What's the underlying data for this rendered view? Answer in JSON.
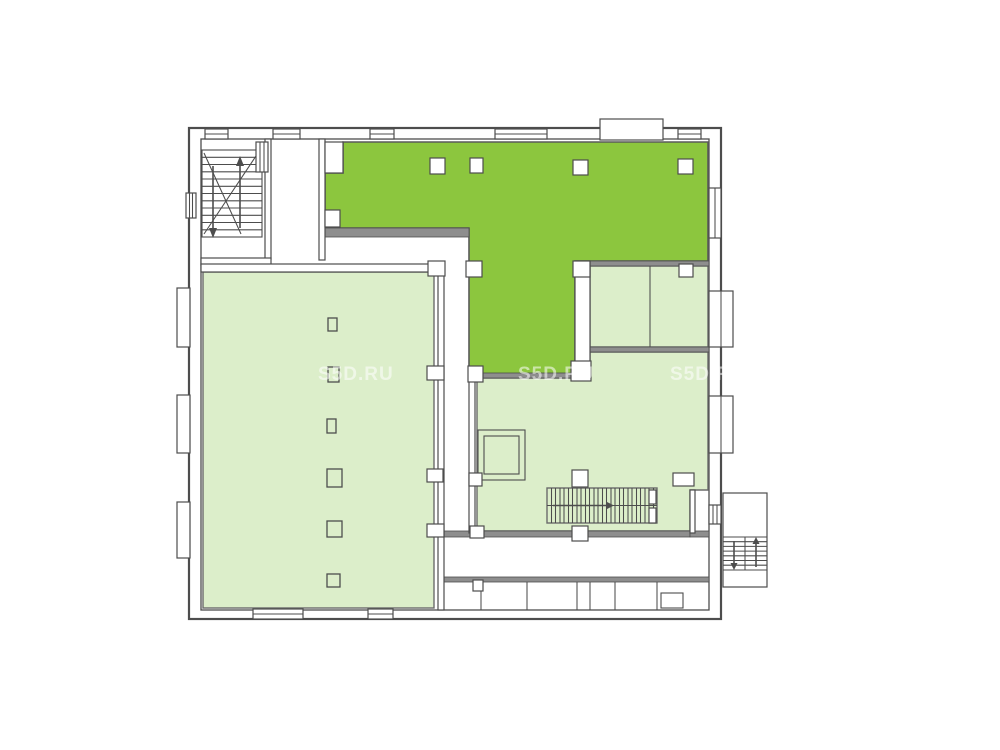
{
  "watermark": {
    "text": "S5D.RU",
    "opacity": 0.55,
    "instances": [
      {
        "x": 318,
        "y": 380
      },
      {
        "x": 518,
        "y": 380
      },
      {
        "x": 670,
        "y": 380
      }
    ]
  },
  "colors": {
    "background": "#ffffff",
    "highlight_green": "#8cc63e",
    "room_green": "#dceeca",
    "wall_dark": "#4d4d4d",
    "wall_mid": "#6b6b6b",
    "heavy_wall_fill": "#8e8e8e",
    "watermark_color": "#ffffff"
  },
  "icons": {
    "stair_up_arrow": "up-arrow",
    "stair_down_arrow": "down-arrow",
    "stair_direction_arrow": "right-arrow"
  }
}
